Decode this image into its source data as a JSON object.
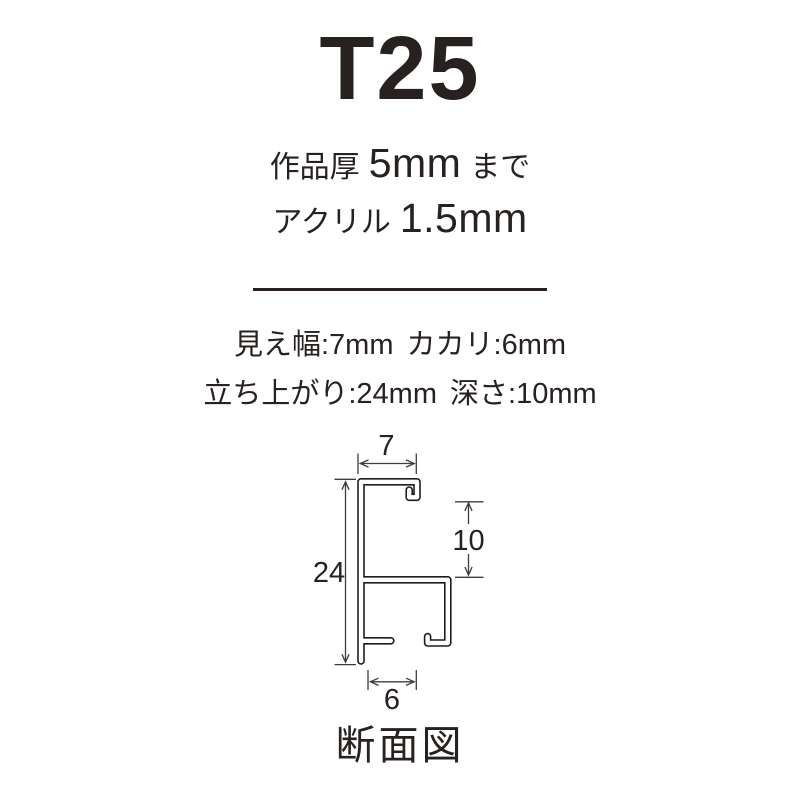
{
  "title": "T25",
  "work_thickness": {
    "label": "作品厚",
    "value": "5mm",
    "suffix": "まで"
  },
  "acrylic": {
    "label": "アクリル",
    "value": "1.5mm"
  },
  "specs": {
    "row1": [
      {
        "label": "見え幅:",
        "value": "7mm"
      },
      {
        "label": "カカリ:",
        "value": "6mm"
      }
    ],
    "row2": [
      {
        "label": "立ち上がり:",
        "value": "24mm"
      },
      {
        "label": "深さ:",
        "value": "10mm"
      }
    ]
  },
  "diagram": {
    "caption": "断面図",
    "dimensions": {
      "top_width_mm": "7",
      "height_mm": "24",
      "inner_depth_mm": "10",
      "bottom_width_mm": "6"
    }
  },
  "colors": {
    "text": "#272220",
    "profile_line": "#1f1d1b",
    "dimension_line": "#3d3d3d",
    "background": "#ffffff"
  }
}
